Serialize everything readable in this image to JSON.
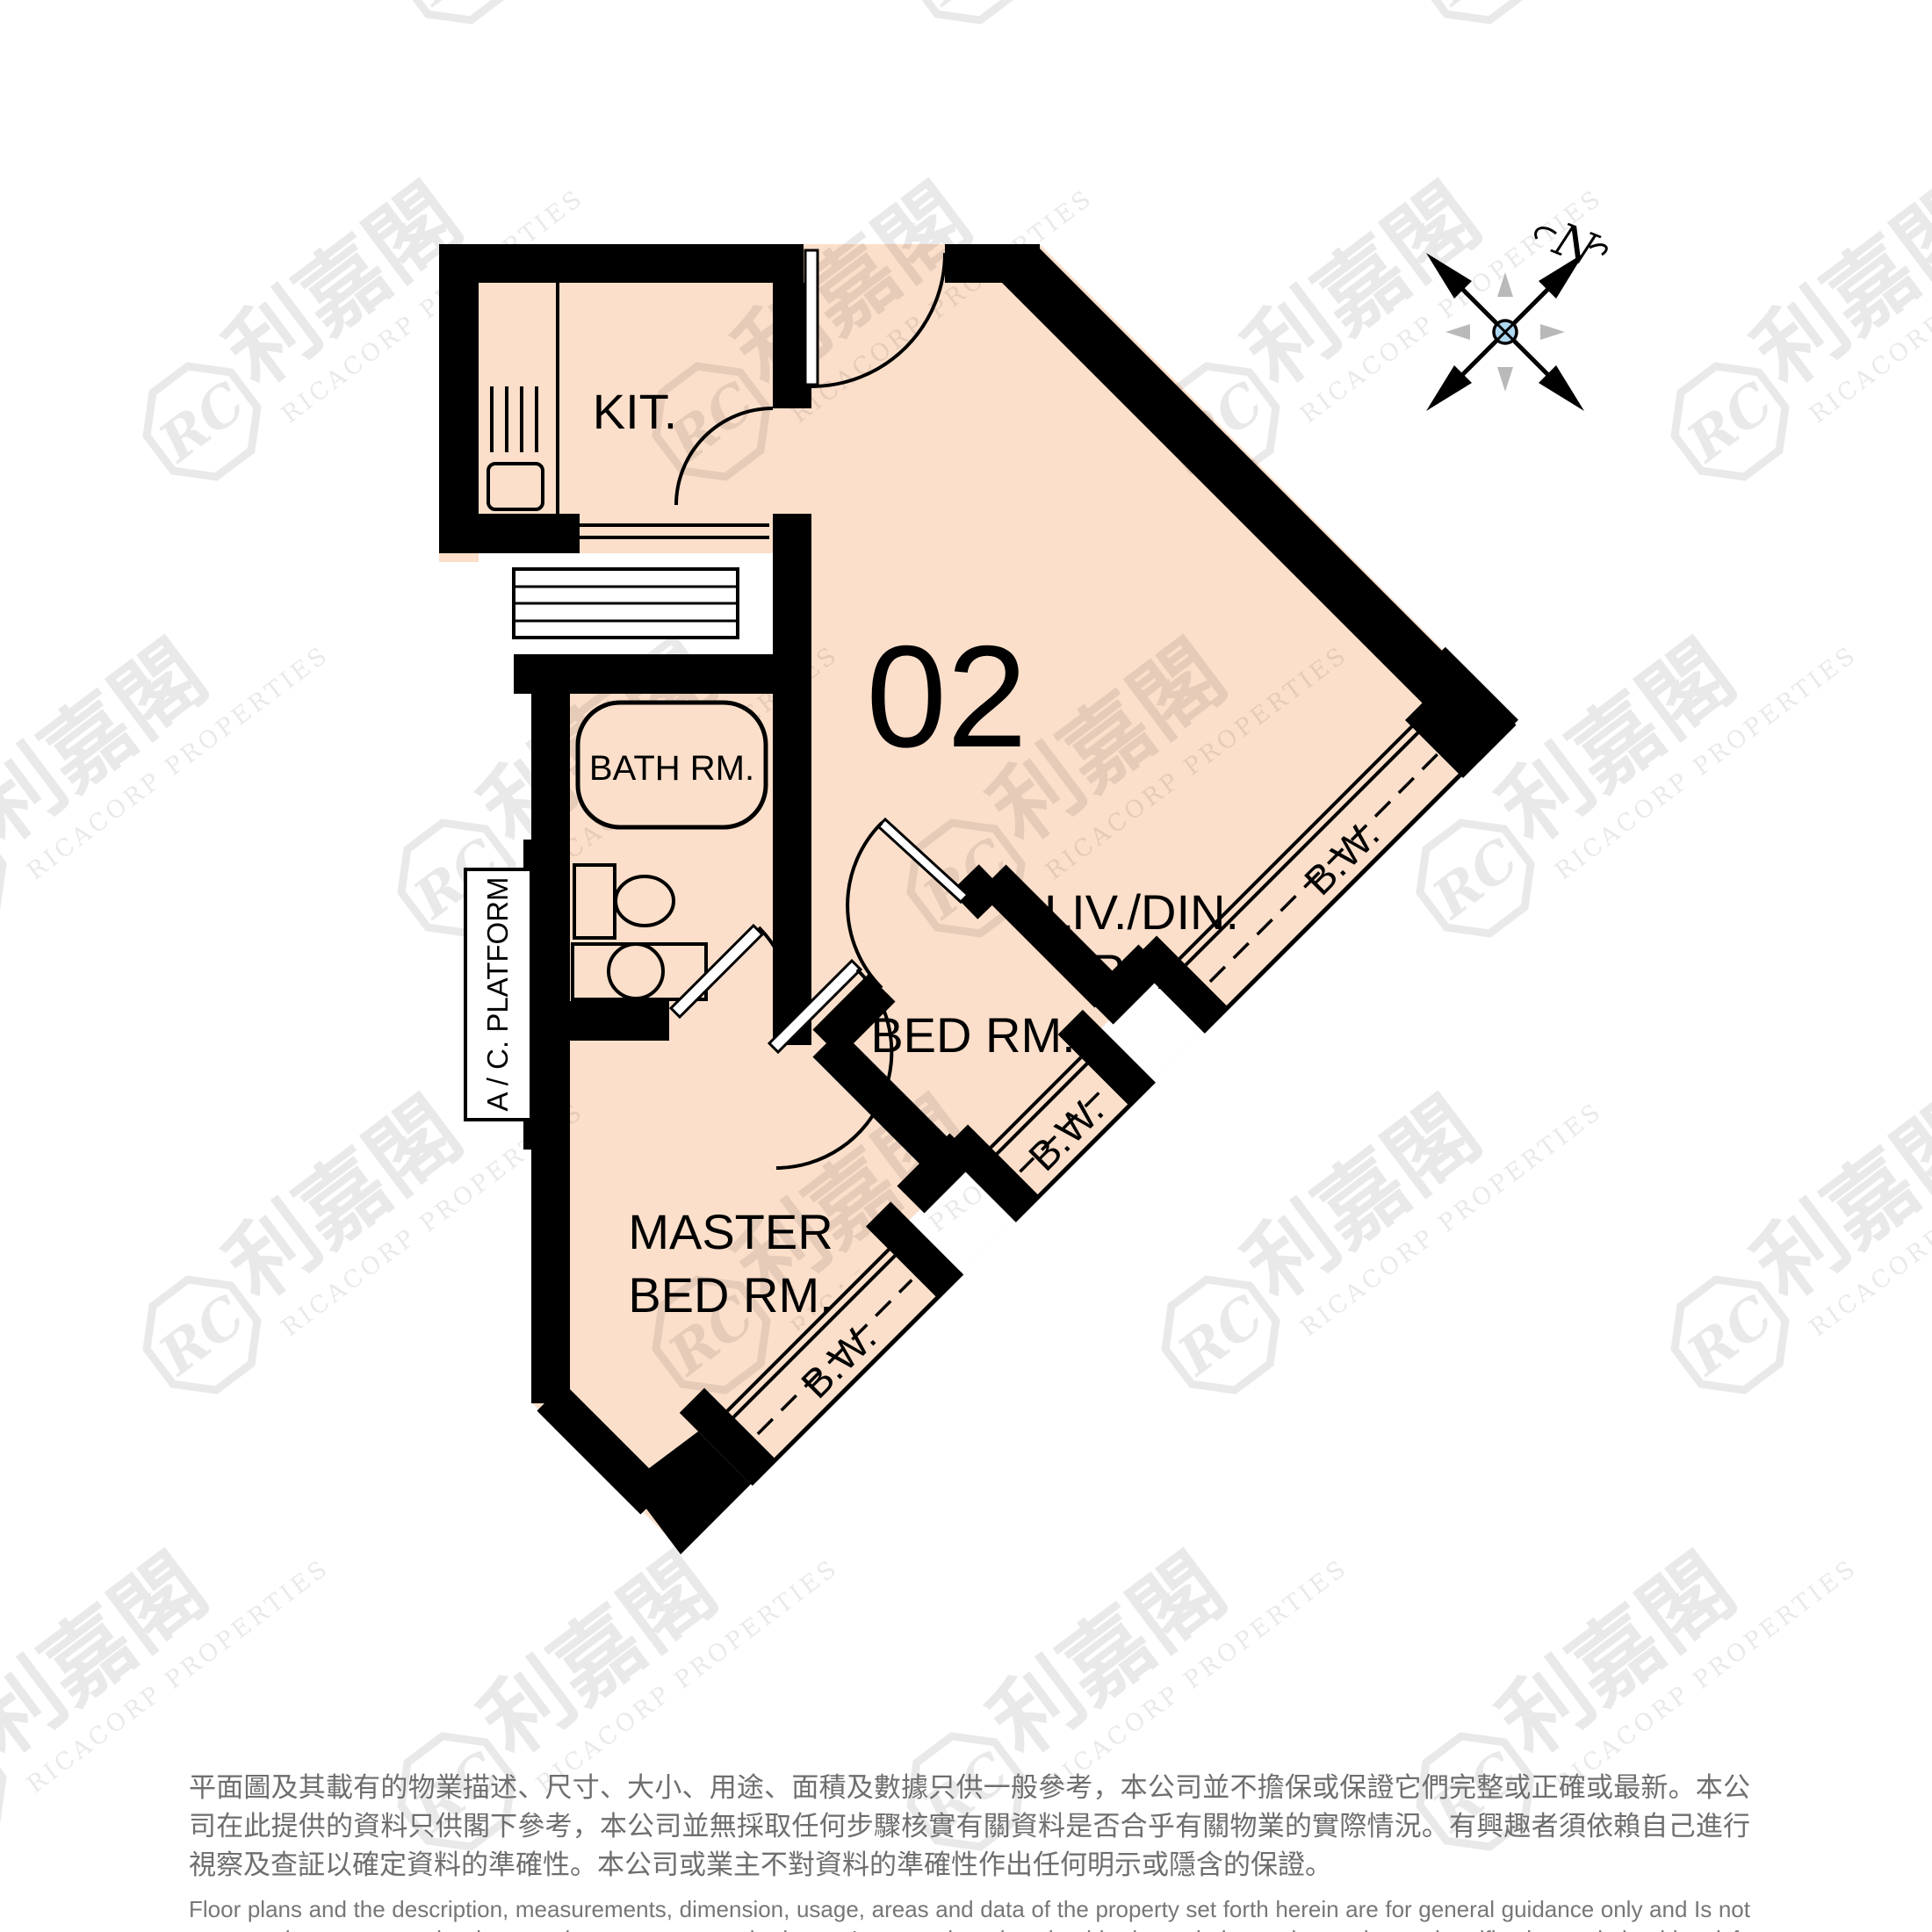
{
  "floorplan": {
    "unit_number": "02",
    "rooms": {
      "kitchen": "KIT.",
      "bathroom": "BATH RM.",
      "living_line1": "LIV./DIN.",
      "living_line2": "RM",
      "bedroom": "BED RM.",
      "master_line1": "MASTER",
      "master_line2": "BED RM.",
      "ac_platform": "A / C. PLATFORM"
    },
    "bay_window_label": "B.W.",
    "colors": {
      "floor": "#fbdfca",
      "wall": "#000000",
      "compass_center": "#aed7f0",
      "watermark": "#e8e8e8",
      "disclaimer_text": "#6e6e6e"
    }
  },
  "compass": {
    "north_label": "N"
  },
  "watermark": {
    "monogram": "RC",
    "cjk": "利嘉閣",
    "latin": "RICACORP PROPERTIES"
  },
  "disclaimer": {
    "zh": "平面圖及其載有的物業描述、尺寸、大小、用途、面積及數據只供一般參考，本公司並不擔保或保證它們完整或正確或最新。本公司在此提供的資料只供閣下參考，本公司並無採取任何步驟核實有關資料是否合乎有關物業的實際情況。有興趣者須依賴自己進行視察及查証以確定資料的準確性。本公司或業主不對資料的準確性作出任何明示或隱含的保證。",
    "en": "Floor plans and the description, measurements, dimension, usage, areas and data of the property set forth herein are for general guidance only and Is not warranted or guaranteed to be complete or correct or the latest. Interested parties should rely on their own inspection and verification and should satisfy themselves as to the accuracy of the particulars contained herein which are provided by us for information only.  Our Company has not taken any step to verify whether the information reflects the actual status of the property.  No warranty for accuracy is given or implied by the owners or us."
  }
}
